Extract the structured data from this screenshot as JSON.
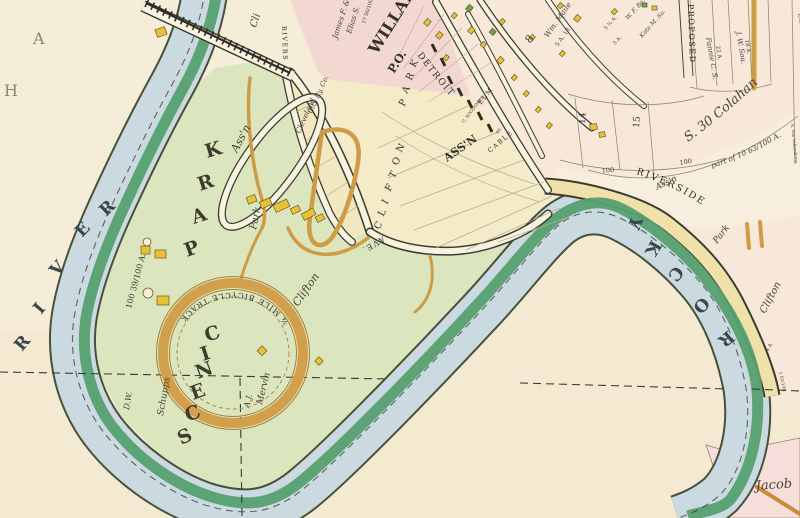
{
  "palette": {
    "paper": "#f3ead1",
    "park_green": "#dbe6bf",
    "river_blue": "#cbdae1",
    "river_bank_green": "#55a070",
    "road_cream": "#f8f2e0",
    "street_yellow": "#efe1a9",
    "block_pink": "#f3d8d2",
    "parcel_pink": "#f7e8da",
    "building_yellow": "#e7c238",
    "track_orange": "#d2a04c",
    "ink": "#2f2d26"
  },
  "letters": {
    "river_left": [
      "R",
      "I",
      "V",
      "E",
      "R"
    ],
    "river_right": [
      "R",
      "O",
      "C",
      "K",
      "Y"
    ],
    "scenic": [
      "S",
      "C",
      "E",
      "N",
      "I",
      "C"
    ],
    "park": [
      "P",
      "A",
      "R",
      "K"
    ],
    "clifton_street": [
      "C",
      "L",
      "I",
      "F",
      "T",
      "O",
      "N"
    ],
    "park_street": [
      "P",
      "A",
      "R",
      "K"
    ],
    "corner_a": "A",
    "corner_h": "H"
  },
  "labels": {
    "willard": "WILLARD",
    "po": "P.O.",
    "assn_big": "ASS'N",
    "detroit": "DETROIT",
    "elm": "ELM",
    "cable": "CABLE",
    "ave": "AVE.",
    "riverside": "RIVERSIDE",
    "rivers_small": "RIVERS",
    "proposed": "PROPOSED",
    "cli": "Cli",
    "bicycle_track": "¾ MILE BICYCLE TRACK",
    "strip_assn": {
      "clifton": "Clifton",
      "park": "Park",
      "assn": "Ass'n"
    },
    "park_assn_italic": {
      "clifton": "Clifton",
      "park": "Park",
      "assn": "Ass'n"
    },
    "acreage_park": "100 39/100 A.",
    "jacob": "Jacob"
  },
  "owners": {
    "dw": "D.W.",
    "schupp": "Schupps",
    "aj": "A.J.",
    "mervin": "Mervin",
    "james": "James F. &",
    "elias": "Elias S.",
    "james_acres": "17 56/100 A.",
    "ccry_1": "Cleveland",
    "ccry_2": "City Ry. Co.",
    "maile": "Wm. Maile",
    "maile_acres": "5 A. 13",
    "wf": "W. F. Ba.",
    "kate": "Kate M. So.",
    "acres_3": "3 A.",
    "acres_5": "5 ¾ A.",
    "fannie": "Fannie C. S.",
    "fannie_acres": "22 A.",
    "jw": "J. W. Sou.",
    "jw_acres": "18 A.",
    "colahan": "S. 30 Colahan",
    "colahan_part": "part of 10 63/100 A.",
    "olive": "Olive B.",
    "valkenburg": "A. Van Valkenburg",
    "strip_name": "C. SOGOTMEN",
    "strip_num": "60",
    "acre_4": "4 A.",
    "acre_163": "1 63/100"
  },
  "numbers": {
    "block_8": "8",
    "lot_14": "14",
    "lot_15": "15",
    "front_100a": "100",
    "front_100b": "100"
  }
}
